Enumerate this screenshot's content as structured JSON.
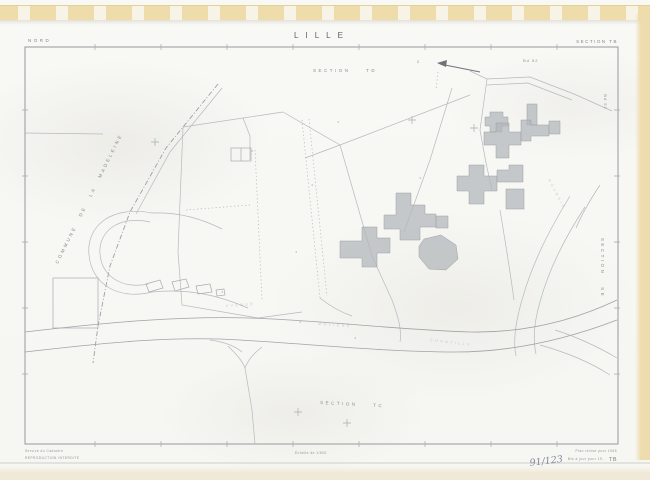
{
  "header": {
    "region": "NORD",
    "title": "LILLE",
    "section": "SECTION TB"
  },
  "map": {
    "adjacent_section_top": "SECTION TD",
    "adjacent_section_bottom": "SECTION TC",
    "adjacent_section_right": "SECTION SE",
    "sheet_ref_top_right": "Bd 52",
    "sheet_ref_right_edge": "Bd 52",
    "arrow_number": "2",
    "commune_boundary_label": "COMMUNE DE LA MADELEINE",
    "street_labels": {
      "avenue": "AVENUE",
      "moliere": "MOLIERE",
      "chantilly": "CHANTILLY",
      "roubaix": "ROUBAIX"
    }
  },
  "footer": {
    "agency_line1": "Service du Cadastre",
    "agency_line2": "REPRODUCTION INTERDITE",
    "scale": "Échelle de 1/500",
    "revision_line1": "Plan révisé pour 1965",
    "revision_line2": "Mis à jour pour 19..",
    "sheet_code": "TB",
    "handwritten_ref": "91/123"
  },
  "colors": {
    "film_strip": "#efdcab",
    "paper": "#f7f7f4",
    "frame_ink": "#97999c",
    "map_ink_faint": "#b6babd",
    "building_fill": "#b2b6ba",
    "handwriting": "#8088a0"
  }
}
